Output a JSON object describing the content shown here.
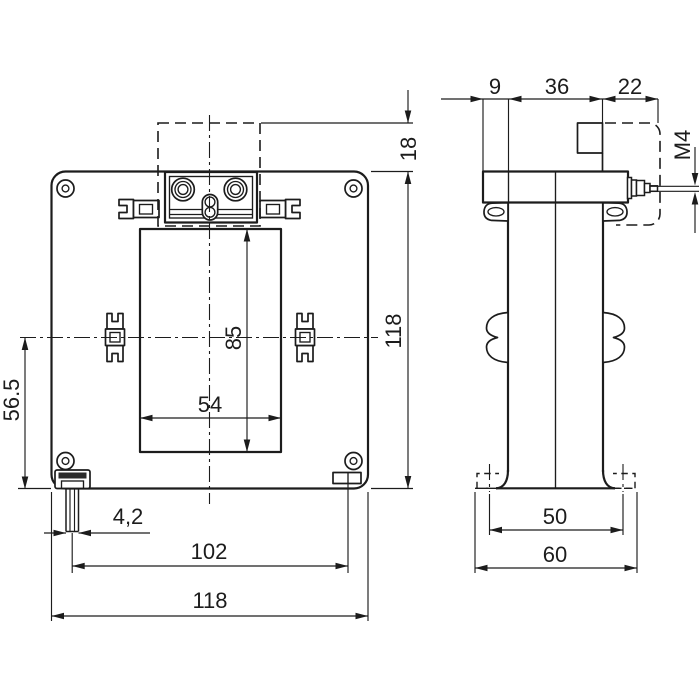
{
  "colors": {
    "line": "#1c1c1c",
    "background": "#ffffff"
  },
  "front_view": {
    "dims": {
      "cover_projection": "18",
      "height": "118",
      "window_height": "85",
      "window_width": "54",
      "center_to_base": "56.5",
      "slot_width": "4,2",
      "mount_spacing": "102",
      "width": "118"
    }
  },
  "side_view": {
    "dims": {
      "bracket_width": "9",
      "body_depth": "36",
      "cover_depth": "22",
      "terminal_thread": "M4",
      "foot_slot_spacing": "50",
      "base_depth": "60"
    }
  }
}
